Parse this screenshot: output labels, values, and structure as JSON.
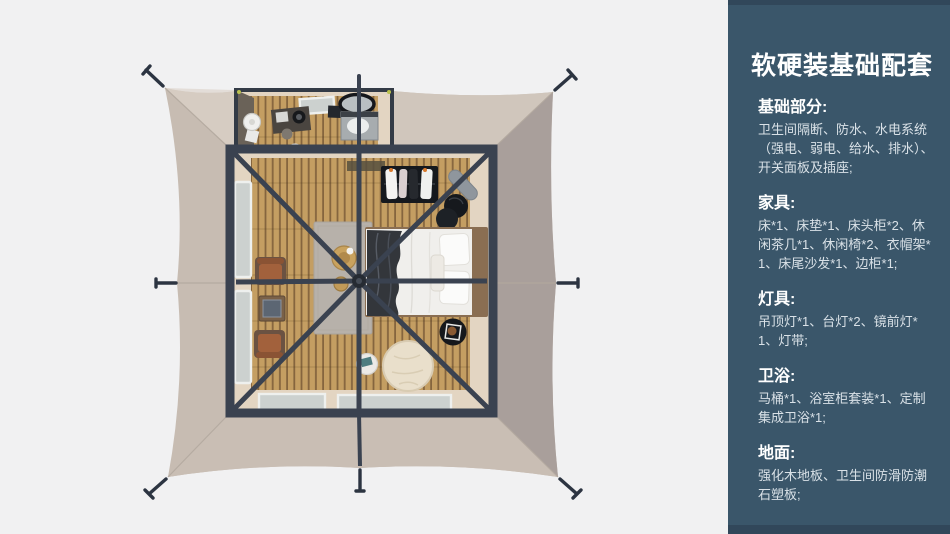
{
  "panel": {
    "title": "软硬装基础配套",
    "sections": [
      {
        "heading": "基础部分:",
        "body": "卫生间隔断、防水、水电系统（强电、弱电、给水、排水）、开关面板及插座;"
      },
      {
        "heading": "家具:",
        "body": "床*1、床垫*1、床头柜*2、休闲茶几*1、休闲椅*2、衣帽架*1、床尾沙发*1、边柜*1;"
      },
      {
        "heading": "灯具:",
        "body": "吊顶灯*1、台灯*2、镜前灯*1、灯带;"
      },
      {
        "heading": "卫浴:",
        "body": "马桶*1、浴室柜套装*1、定制集成卫浴*1;"
      },
      {
        "heading": "地面:",
        "body": "强化木地板、卫生间防滑防潮石塑板;"
      }
    ]
  },
  "scene": {
    "items": [
      "tent-canvas",
      "tent-frame",
      "guy-line-stakes",
      "bathroom",
      "bed",
      "pillows",
      "blanket",
      "bedside-nesting-tables",
      "wardrobe-rack",
      "leisure-chairs",
      "tea-table",
      "rug",
      "straw-hat",
      "bean-bag-pouf",
      "side-table",
      "tray-table",
      "windows",
      "wood-floor"
    ]
  },
  "colors": {
    "page-bg": "#f1f1f2",
    "panel-bg": "#3a566a",
    "panel-edge": "#31475a",
    "panel-heading": "#ffffff",
    "panel-text": "#d9e1e7",
    "tent-fabric": "#c7bcb2",
    "tent-fabric-dark": "#a99f9b",
    "tent-frame": "#3a4250",
    "wood-floor": "#c49e62",
    "wood-gap": "#85653e"
  }
}
